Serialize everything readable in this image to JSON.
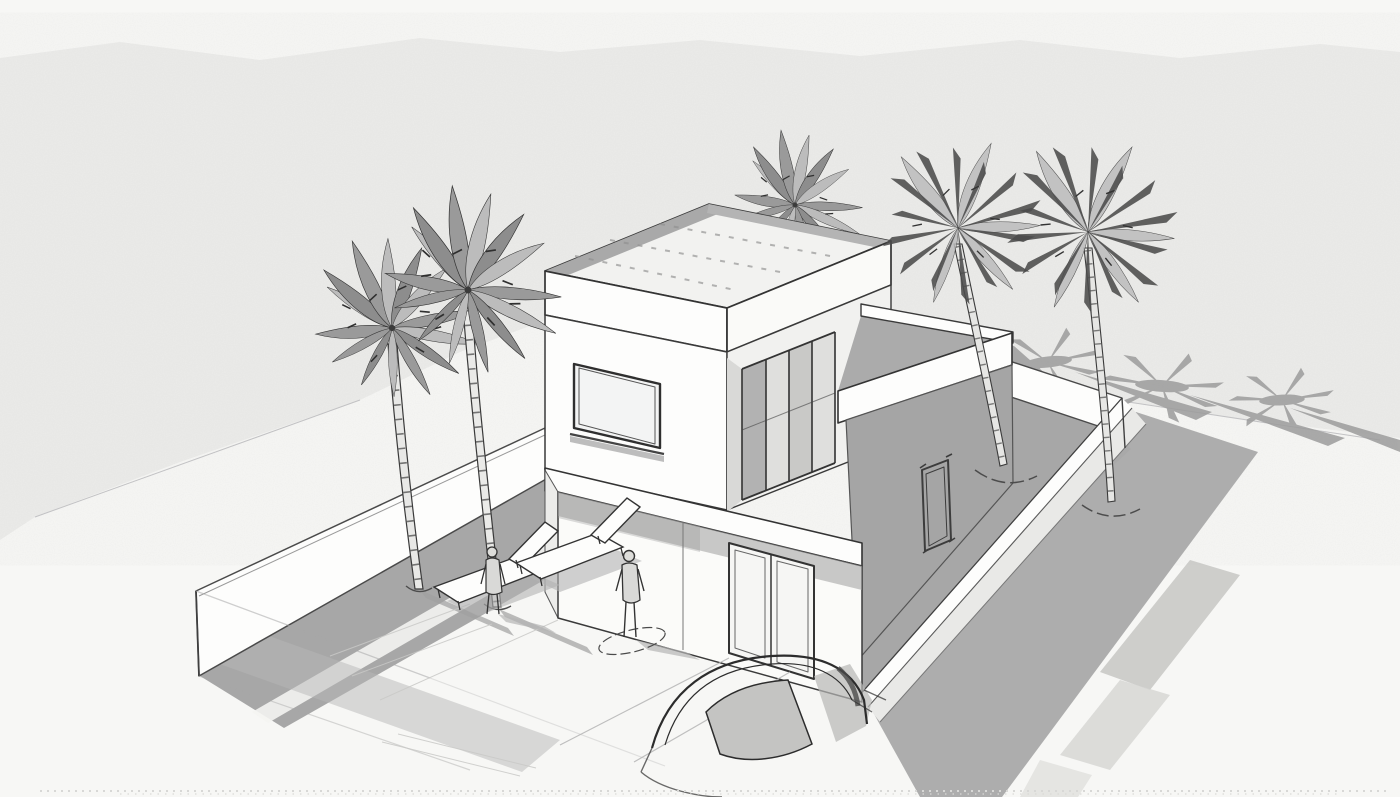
{
  "meta": {
    "type": "architectural-concept-sketch",
    "title": "Two-storey modern flat-roof villa — aerial three-quarter pencil and wash sketch",
    "medium": "pencil-line with gray wash on textured paper"
  },
  "palette": {
    "paper": "#f7f7f5",
    "wash": "#ebebe9",
    "ink": "#3a3a3a",
    "inkSoft": "#8a8a8a",
    "white": "#fdfdfc",
    "shadow": "#a7a7a7",
    "shadowLight": "#c9c9c9",
    "shadowDeep": "#9a9a98",
    "glassDark": "#b2b2b2",
    "glassMid": "#c9c9c7",
    "glassLight": "#dfdfdd"
  },
  "scene": {
    "building": {
      "storeys": 2,
      "roof": "flat with parapet and hatched deck",
      "features": [
        "large-front-window",
        "sliding-glass-doors",
        "roof-terrace-parapet",
        "entrance-double-door",
        "side-window",
        "cantilevered-upper-floor",
        "single-storey-right-wing"
      ]
    },
    "site": {
      "perimeter_walls": 4,
      "areas": [
        "left-courtyard-with-deck",
        "forecourt-walkway",
        "right-side-yard"
      ],
      "cast_shadows": [
        "left-wall-shadow-band",
        "right-wall-exterior-shadow",
        "building-side-shadow"
      ]
    },
    "vegetation": {
      "palm_trees_total": 5,
      "palms_left_courtyard": 2,
      "palm_behind_house": 1,
      "palms_right_yard": 2,
      "palm_frond_ground_shadows": 3
    },
    "furniture": {
      "sun_loungers": 2
    },
    "people": 2,
    "vehicles": {
      "cars_foreground": 1
    }
  }
}
